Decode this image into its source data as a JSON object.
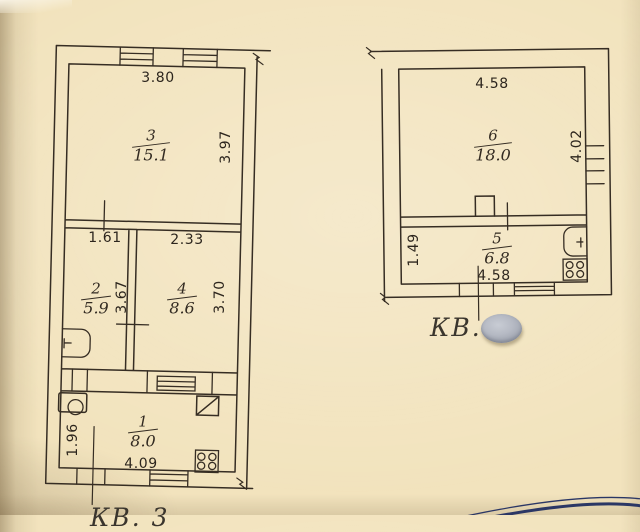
{
  "document": {
    "type": "apartment-floor-plan-scan",
    "language": "ru"
  },
  "colors": {
    "paper": "#f2e3bd",
    "ink": "#362d23",
    "sticker": "#b6bac4",
    "stamp": "#2b3765"
  },
  "plans": {
    "left": {
      "caption": "КВ. 3",
      "rooms": [
        {
          "number": "3",
          "area": "15.1"
        },
        {
          "number": "2",
          "area": "5.9"
        },
        {
          "number": "4",
          "area": "8.6"
        },
        {
          "number": "1",
          "area": "8.0"
        }
      ],
      "dims": {
        "room3_top": "3.80",
        "room3_right": "3.97",
        "room2_top": "1.61",
        "room2_right": "3.67",
        "room4_top": "2.33",
        "room4_right": "3.70",
        "room1_left": "1.96",
        "room1_bottom": "4.09"
      }
    },
    "right": {
      "caption": "КВ.",
      "rooms": [
        {
          "number": "6",
          "area": "18.0"
        },
        {
          "number": "5",
          "area": "6.8"
        }
      ],
      "dims": {
        "room6_top": "4.58",
        "room6_right": "4.02",
        "room5_left": "1.49",
        "room5_bottom": "4.58"
      }
    }
  },
  "fixtures": {
    "left_plan": [
      "washbasin-icon",
      "vent-shaft-icon",
      "stove-4-burner-icon",
      "sink-icon"
    ],
    "right_plan": [
      "sink-icon",
      "stove-4-burner-icon",
      "chimney-icon"
    ]
  },
  "overlays": {
    "sticker_note": "grey oval sticker covering apartment number",
    "stamp_note": "edge of round ink stamp, bottom right"
  }
}
